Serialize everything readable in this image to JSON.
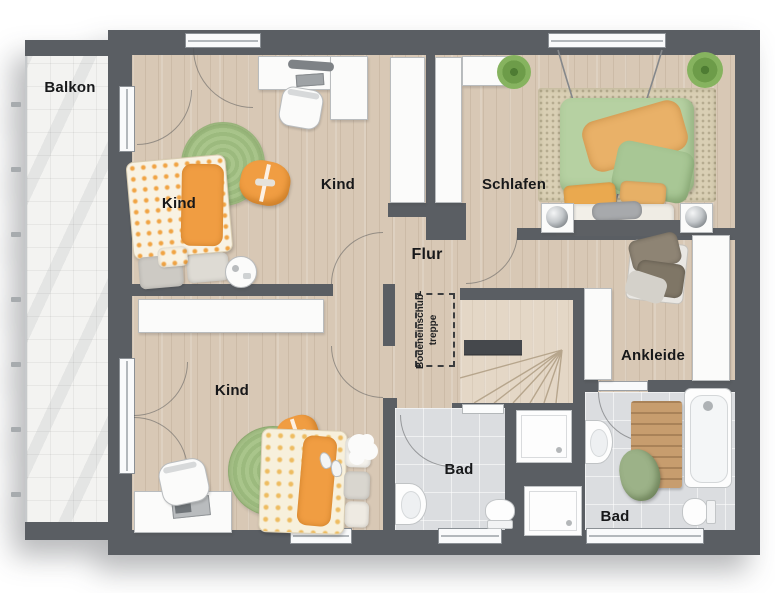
{
  "rooms": {
    "balkon": {
      "label": "Balkon"
    },
    "kind_top": {
      "label": "Kind"
    },
    "kind_mid": {
      "label": "Kind"
    },
    "kind_bottom": {
      "label": "Kind"
    },
    "schlafen": {
      "label": "Schlafen"
    },
    "flur": {
      "label": "Flur"
    },
    "ankleide": {
      "label": "Ankleide"
    },
    "bad_center": {
      "label": "Bad"
    },
    "bad_right": {
      "label": "Bad"
    },
    "attic_stairs": {
      "line1": "Bodeneinschub-",
      "line2": "treppe"
    }
  },
  "colors": {
    "wall": "#5a5e63",
    "wood": "#d8c8b5",
    "wood_light": "#e4d7c6",
    "balcony_tile": "#f3f3f1",
    "bath_tile": "#dbdde0",
    "rug_green": "#a9c58b",
    "orange": "#f09d42",
    "duvet_green": "#b6d1a2",
    "throw_orange": "#e9b168",
    "towel_green": "#9cb288",
    "mat_wood": "#c79d6e",
    "furniture_white": "#fbfbfa"
  }
}
